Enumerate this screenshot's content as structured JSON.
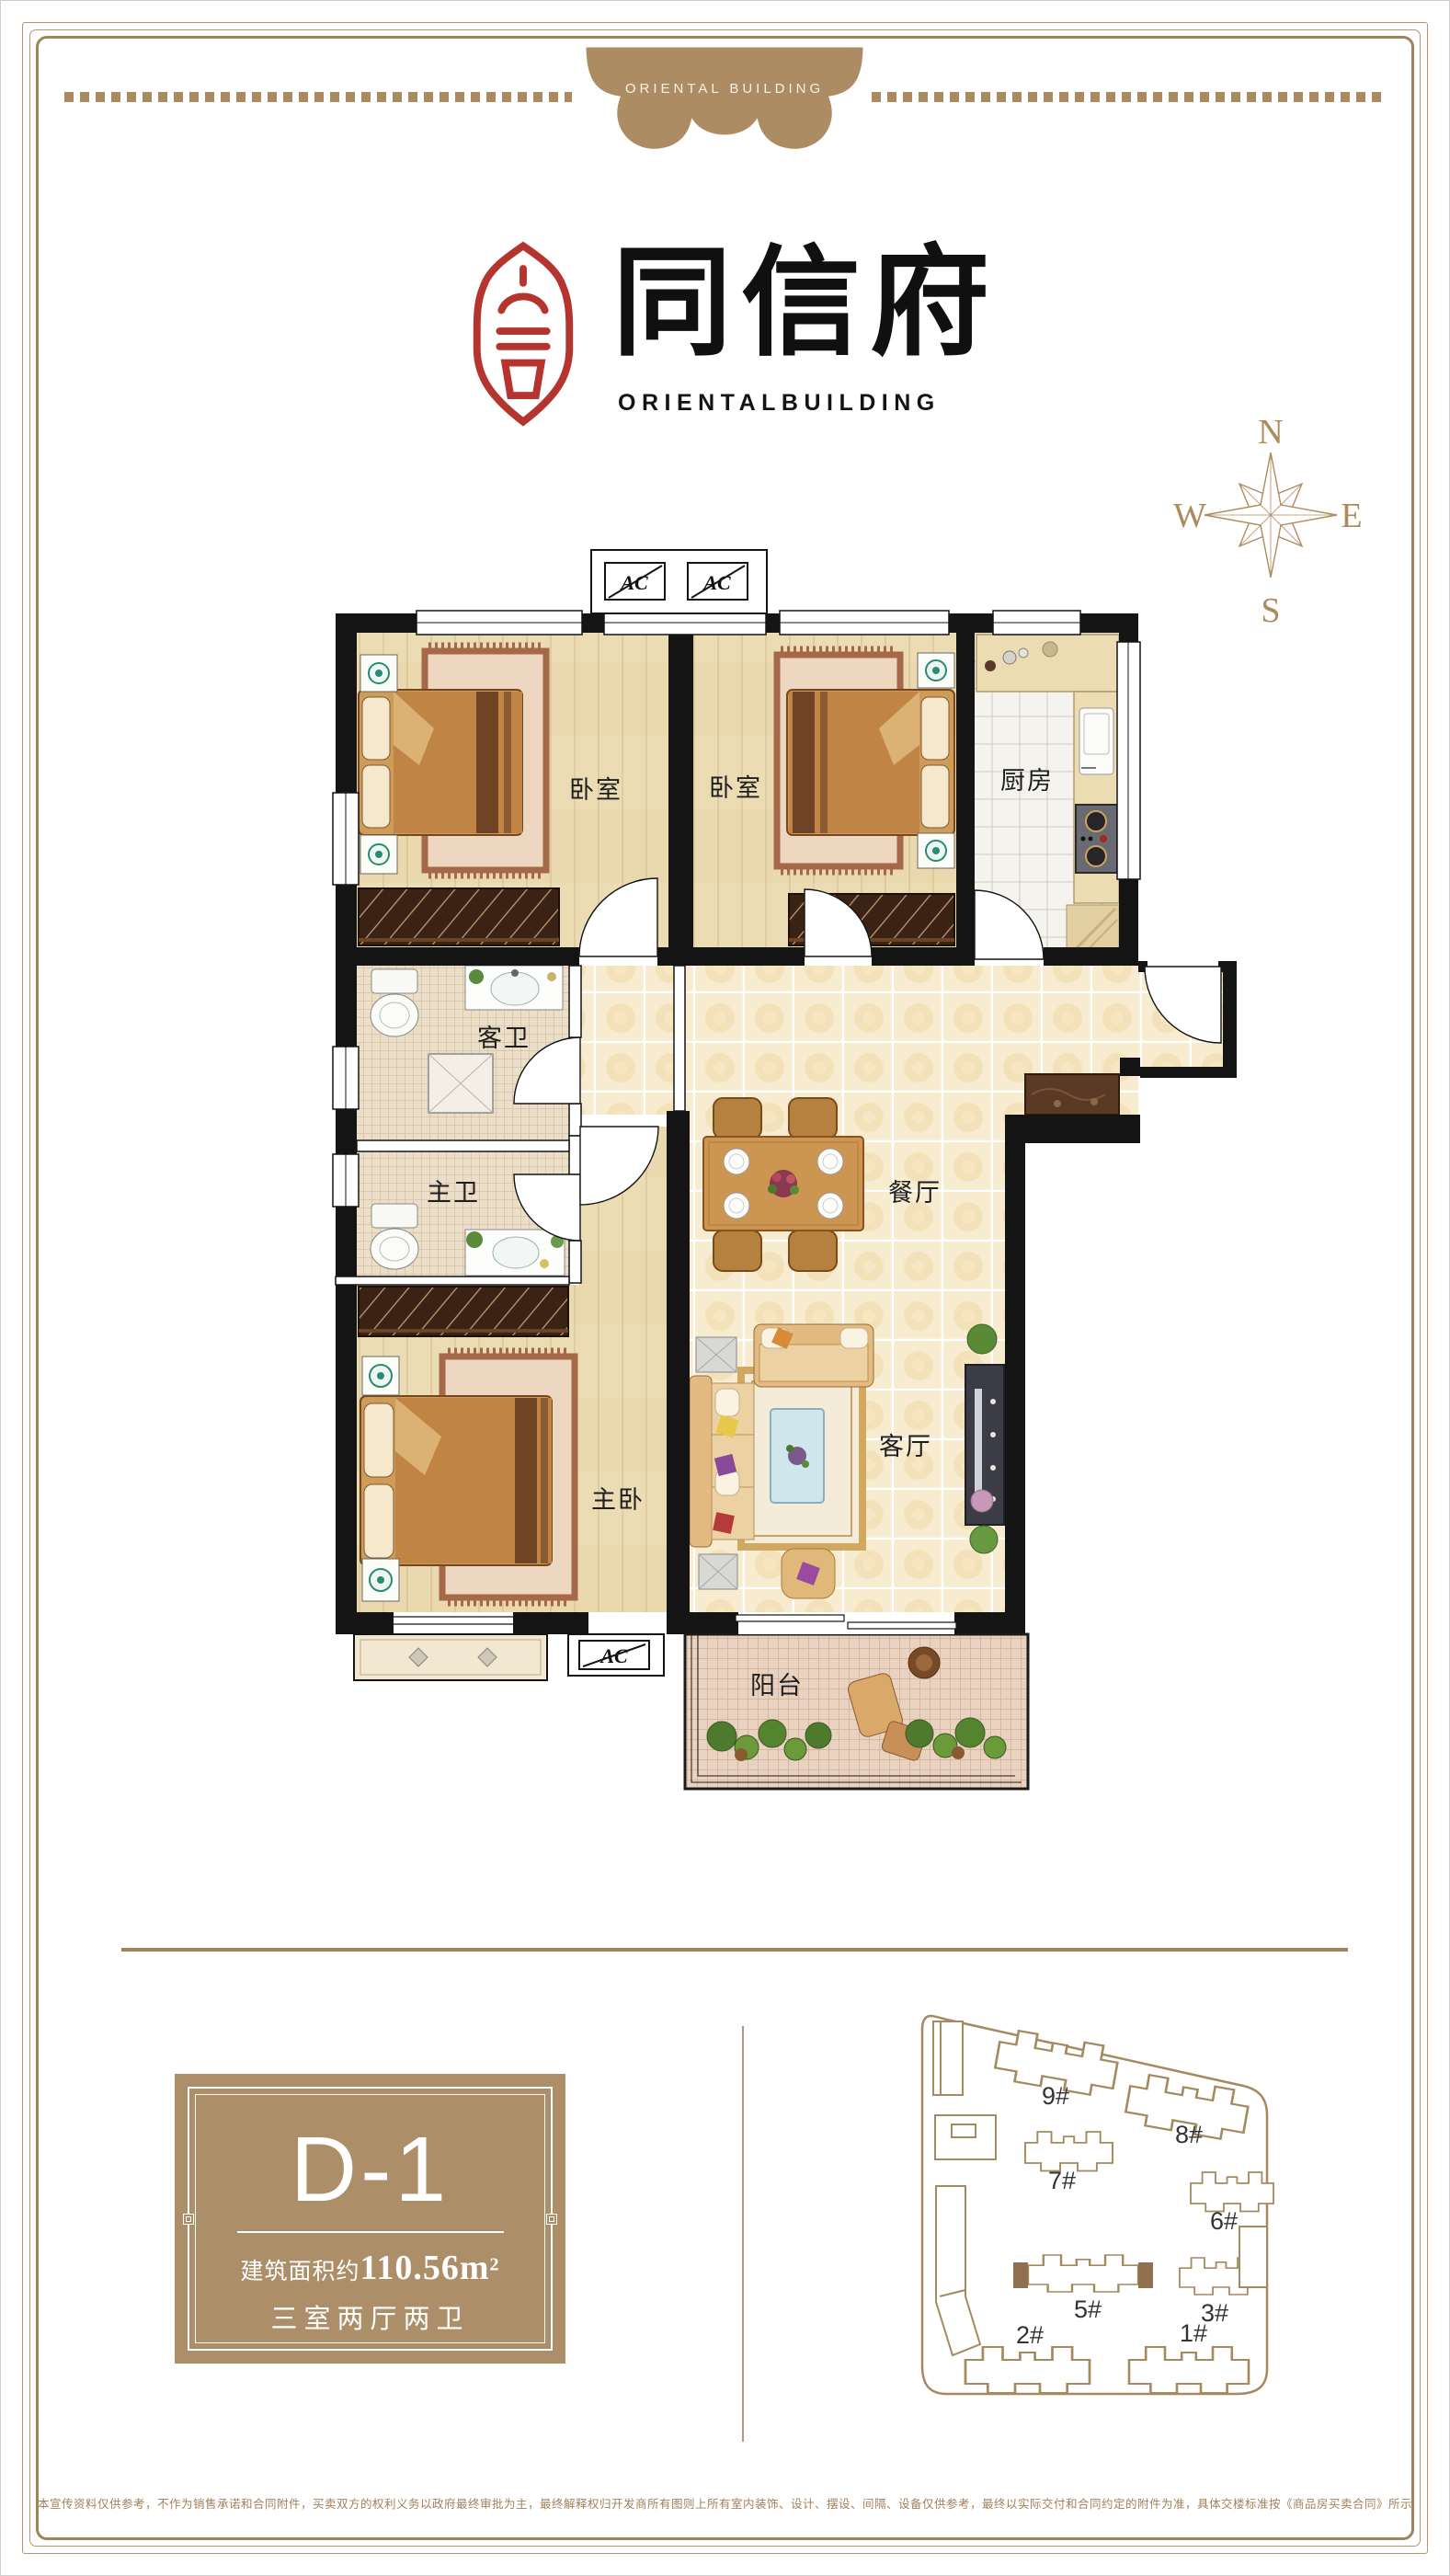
{
  "banner": {
    "text": "ORIENTAL BUILDING"
  },
  "brand": {
    "name": "同信府",
    "english": "ORIENTALBUILDING"
  },
  "compass": {
    "n": "N",
    "e": "E",
    "s": "S",
    "w": "W"
  },
  "floorplan": {
    "ac": "AC",
    "rooms": {
      "bedroom1": "卧室",
      "bedroom2": "卧室",
      "kitchen": "厨房",
      "guest_bath": "客卫",
      "master_bath": "主卫",
      "dining": "餐厅",
      "living": "客厅",
      "master_bedroom": "主卧",
      "balcony": "阳台"
    }
  },
  "unit_card": {
    "name": "D-1",
    "area_prefix": "建筑面积约",
    "area_number": "110.56m",
    "area_sup": "2",
    "layout": "三室两厅两卫"
  },
  "siteplan": {
    "buildings": [
      {
        "label": "9#"
      },
      {
        "label": "8#"
      },
      {
        "label": "7#"
      },
      {
        "label": "6#"
      },
      {
        "label": "5#"
      },
      {
        "label": "3#"
      },
      {
        "label": "2#"
      },
      {
        "label": "1#"
      }
    ]
  },
  "disclaimer": {
    "text": "本宣传资料仅供参考，不作为销售承诺和合同附件，买卖双方的权利义务以政府最终审批为主，最终解释权归开发商所有图则上所有室内装饰、设计、摆设、间隔、设备仅供参考，最终以实际交付和合同约定的附件为准，具体交楼标准按《商品房买卖合同》所示"
  }
}
